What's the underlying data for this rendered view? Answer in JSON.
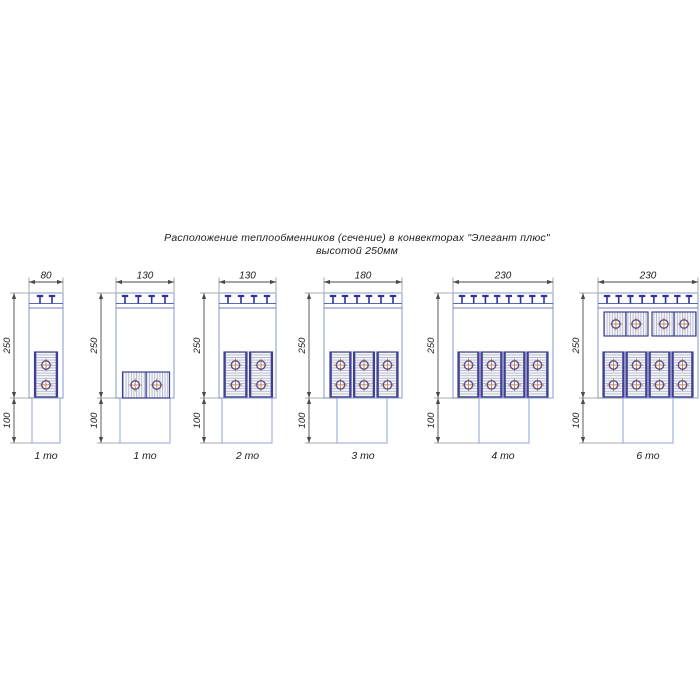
{
  "title": {
    "line1": "Расположение теплообменников (сечение) в конвекторах \"Элегант плюс\"",
    "line2": "высотой 250мм"
  },
  "common": {
    "body_height_label": "250",
    "pedestal_height_label": "100"
  },
  "colors": {
    "body_stroke": "#9aabd4",
    "band_line": "#5b68b8",
    "tee": "#31319a",
    "block_stroke": "#3f3f93",
    "block_fill": "#f5f5f8",
    "hatch": "#a9b2c6",
    "circle_ring": "#5c4e91",
    "crosshair": "#c2824e",
    "dim_line": "#4a4a4a",
    "ext_line": "#8f8f8f",
    "text": "#1c1c1c"
  },
  "diagrams": [
    {
      "label": "1 то",
      "width_label": "80",
      "body": {
        "x": 29,
        "w": 34
      },
      "pedestal": {
        "x": 32,
        "w": 28
      },
      "tee_count": 2,
      "blocks": [
        {
          "x": 34.5,
          "y": 352,
          "w": 23,
          "h": 45,
          "hatch": "h",
          "circles": "v"
        }
      ]
    },
    {
      "label": "1 то",
      "width_label": "130",
      "body": {
        "x": 116,
        "w": 58
      },
      "pedestal": {
        "x": 120,
        "w": 50
      },
      "tee_count": 4,
      "blocks": [
        {
          "x": 122.5,
          "y": 372,
          "w": 47,
          "h": 26,
          "hatch": "v",
          "circles": "h"
        }
      ]
    },
    {
      "label": "2 то",
      "width_label": "130",
      "body": {
        "x": 219,
        "w": 57
      },
      "pedestal": {
        "x": 222,
        "w": 50
      },
      "tee_count": 4,
      "blocks": [
        {
          "x": 224,
          "y": 352,
          "w": 23,
          "h": 45,
          "hatch": "h",
          "circles": "v"
        },
        {
          "x": 249.5,
          "y": 352,
          "w": 23,
          "h": 45,
          "hatch": "h",
          "circles": "v"
        }
      ]
    },
    {
      "label": "3 то",
      "width_label": "180",
      "body": {
        "x": 324,
        "w": 78
      },
      "pedestal": {
        "x": 337,
        "w": 50
      },
      "tee_count": 6,
      "blocks": [
        {
          "x": 330,
          "y": 352,
          "w": 21,
          "h": 45,
          "hatch": "h",
          "circles": "v"
        },
        {
          "x": 353.5,
          "y": 352,
          "w": 21,
          "h": 45,
          "hatch": "h",
          "circles": "v"
        },
        {
          "x": 377,
          "y": 352,
          "w": 21,
          "h": 45,
          "hatch": "h",
          "circles": "v"
        }
      ]
    },
    {
      "label": "4 то",
      "width_label": "230",
      "body": {
        "x": 453,
        "w": 100
      },
      "pedestal": {
        "x": 479,
        "w": 50
      },
      "tee_count": 8,
      "blocks": [
        {
          "x": 458,
          "y": 352,
          "w": 21,
          "h": 45,
          "hatch": "h",
          "circles": "v"
        },
        {
          "x": 481,
          "y": 352,
          "w": 21,
          "h": 45,
          "hatch": "h",
          "circles": "v"
        },
        {
          "x": 504,
          "y": 352,
          "w": 21,
          "h": 45,
          "hatch": "h",
          "circles": "v"
        },
        {
          "x": 527,
          "y": 352,
          "w": 21,
          "h": 45,
          "hatch": "h",
          "circles": "v"
        }
      ]
    },
    {
      "label": "6 то",
      "width_label": "230",
      "body": {
        "x": 598,
        "w": 100
      },
      "pedestal": {
        "x": 623,
        "w": 50
      },
      "tee_count": 8,
      "blocks": [
        {
          "x": 604,
          "y": 312,
          "w": 44,
          "h": 24,
          "hatch": "v",
          "circles": "h"
        },
        {
          "x": 652,
          "y": 312,
          "w": 44,
          "h": 24,
          "hatch": "v",
          "circles": "h"
        },
        {
          "x": 603,
          "y": 352,
          "w": 21,
          "h": 45,
          "hatch": "h",
          "circles": "v"
        },
        {
          "x": 626,
          "y": 352,
          "w": 21,
          "h": 45,
          "hatch": "h",
          "circles": "v"
        },
        {
          "x": 649,
          "y": 352,
          "w": 21,
          "h": 45,
          "hatch": "h",
          "circles": "v"
        },
        {
          "x": 672,
          "y": 352,
          "w": 21,
          "h": 45,
          "hatch": "h",
          "circles": "v"
        }
      ]
    }
  ]
}
